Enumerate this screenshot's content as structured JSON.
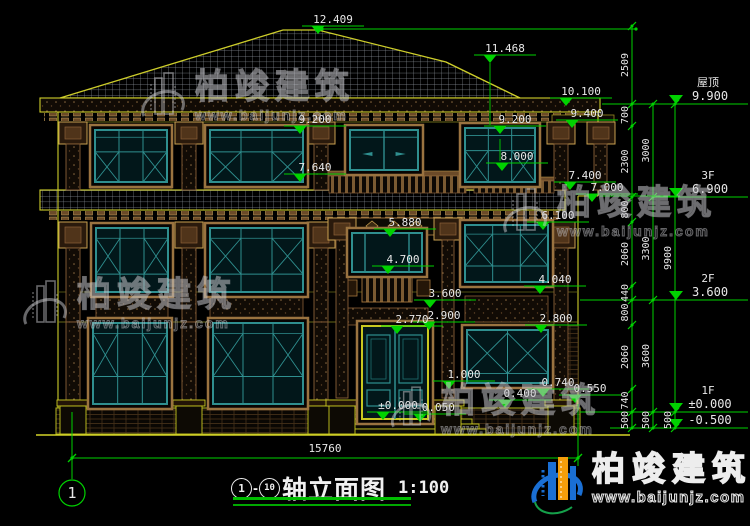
{
  "drawing": {
    "type": "architectural-elevation",
    "title": {
      "axis_from": "1",
      "separator": "-",
      "axis_to": "10",
      "name": "轴立面图",
      "scale": "1:100"
    },
    "axis_bubble": "1",
    "overall_width_mm": "15760",
    "levels": [
      {
        "name": "屋顶",
        "elevation": "9.900",
        "value": 9.9
      },
      {
        "name": "3F",
        "elevation": "6.900",
        "value": 6.9
      },
      {
        "name": "2F",
        "elevation": "3.600",
        "value": 3.6
      },
      {
        "name": "1F",
        "elevation": "±0.000",
        "value": 0
      },
      {
        "name": "",
        "elevation": "-0.500",
        "value": -0.5
      }
    ],
    "elevation_markers": [
      {
        "label": "12.409",
        "value": 12.409,
        "x": 318
      },
      {
        "label": "11.468",
        "value": 11.468,
        "x": 490
      },
      {
        "label": "10.100",
        "value": 10.1,
        "x": 566
      },
      {
        "label": "9.400",
        "value": 9.4,
        "x": 572
      },
      {
        "label": "9.200",
        "value": 9.2,
        "x": 300
      },
      {
        "label": "9.200",
        "value": 9.2,
        "x": 500
      },
      {
        "label": "8.000",
        "value": 8.0,
        "x": 502
      },
      {
        "label": "7.640",
        "value": 7.64,
        "x": 300
      },
      {
        "label": "7.400",
        "value": 7.4,
        "x": 570
      },
      {
        "label": "7.000",
        "value": 7.0,
        "x": 592
      },
      {
        "label": "6.100",
        "value": 6.1,
        "x": 543
      },
      {
        "label": "5.880",
        "value": 5.88,
        "x": 390
      },
      {
        "label": "4.700",
        "value": 4.7,
        "x": 388
      },
      {
        "label": "4.040",
        "value": 4.04,
        "x": 540
      },
      {
        "label": "3.600",
        "value": 3.6,
        "x": 430
      },
      {
        "label": "2.900",
        "value": 2.9,
        "x": 429
      },
      {
        "label": "2.770",
        "value": 2.77,
        "x": 397
      },
      {
        "label": "2.800",
        "value": 2.8,
        "x": 541
      },
      {
        "label": "1.000",
        "value": 1.0,
        "x": 449
      },
      {
        "label": "0.740",
        "value": 0.74,
        "x": 543
      },
      {
        "label": "0.400",
        "value": 0.4,
        "x": 505
      },
      {
        "label": "0.550",
        "value": 0.55,
        "x": 575
      },
      {
        "label": "±0.000",
        "value": 0,
        "x": 383
      },
      {
        "label": "-0.050",
        "value": -0.05,
        "x": 420
      }
    ],
    "dim_chains": [
      {
        "x": 632,
        "segments": [
          {
            "label": "2509",
            "from": 12.409,
            "to": 9.9
          },
          {
            "label": "700",
            "from": 9.9,
            "to": 9.2
          },
          {
            "label": "2300",
            "from": 9.2,
            "to": 6.9
          },
          {
            "label": "800",
            "from": 6.9,
            "to": 6.1
          },
          {
            "label": "2060",
            "from": 6.1,
            "to": 4.04
          },
          {
            "label": "440",
            "from": 4.04,
            "to": 3.6
          },
          {
            "label": "800",
            "from": 3.6,
            "to": 2.8
          },
          {
            "label": "2060",
            "from": 2.8,
            "to": 0.74
          },
          {
            "label": "740",
            "from": 0.74,
            "to": 0
          },
          {
            "label": "500",
            "from": 0,
            "to": -0.5
          }
        ]
      },
      {
        "x": 653,
        "segments": [
          {
            "label": "3000",
            "from": 9.9,
            "to": 6.9
          },
          {
            "label": "3300",
            "from": 6.9,
            "to": 3.6
          },
          {
            "label": "3600",
            "from": 3.6,
            "to": 0
          },
          {
            "label": "500",
            "from": 0,
            "to": -0.5
          }
        ]
      },
      {
        "x": 675,
        "segments": [
          {
            "label": "9900",
            "from": 9.9,
            "to": 0
          },
          {
            "label": "500",
            "from": 0,
            "to": -0.5
          }
        ]
      }
    ]
  },
  "watermark": {
    "brand": "柏竣建筑",
    "url": "www.baijunjz.com"
  },
  "logo": {
    "brand": "柏竣建筑",
    "url": "www.baijunjz.com"
  }
}
